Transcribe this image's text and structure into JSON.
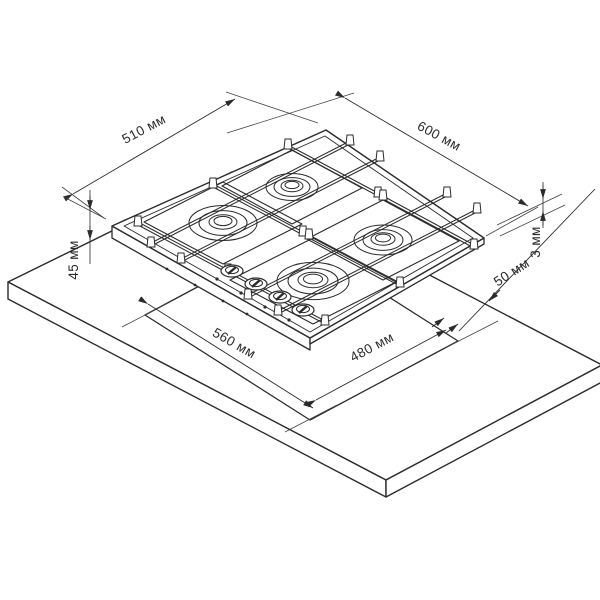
{
  "diagram": {
    "background": "#ffffff",
    "line_color": "#2b2b2b",
    "subject": "gas-hob-installation-drawing",
    "labels": {
      "dim_depth_top": "510 мм",
      "dim_width_top": "600 мм",
      "dim_body_height_left": "45 мм",
      "dim_profile_right": "3 мм",
      "dim_cutout_left": "560 мм",
      "dim_cutout_right": "480 мм",
      "dim_clearance_right": "50 мм"
    },
    "components": [
      "countertop",
      "cutout-opening",
      "gas-hob",
      "pan-support-grates",
      "burners",
      "control-knobs"
    ]
  }
}
